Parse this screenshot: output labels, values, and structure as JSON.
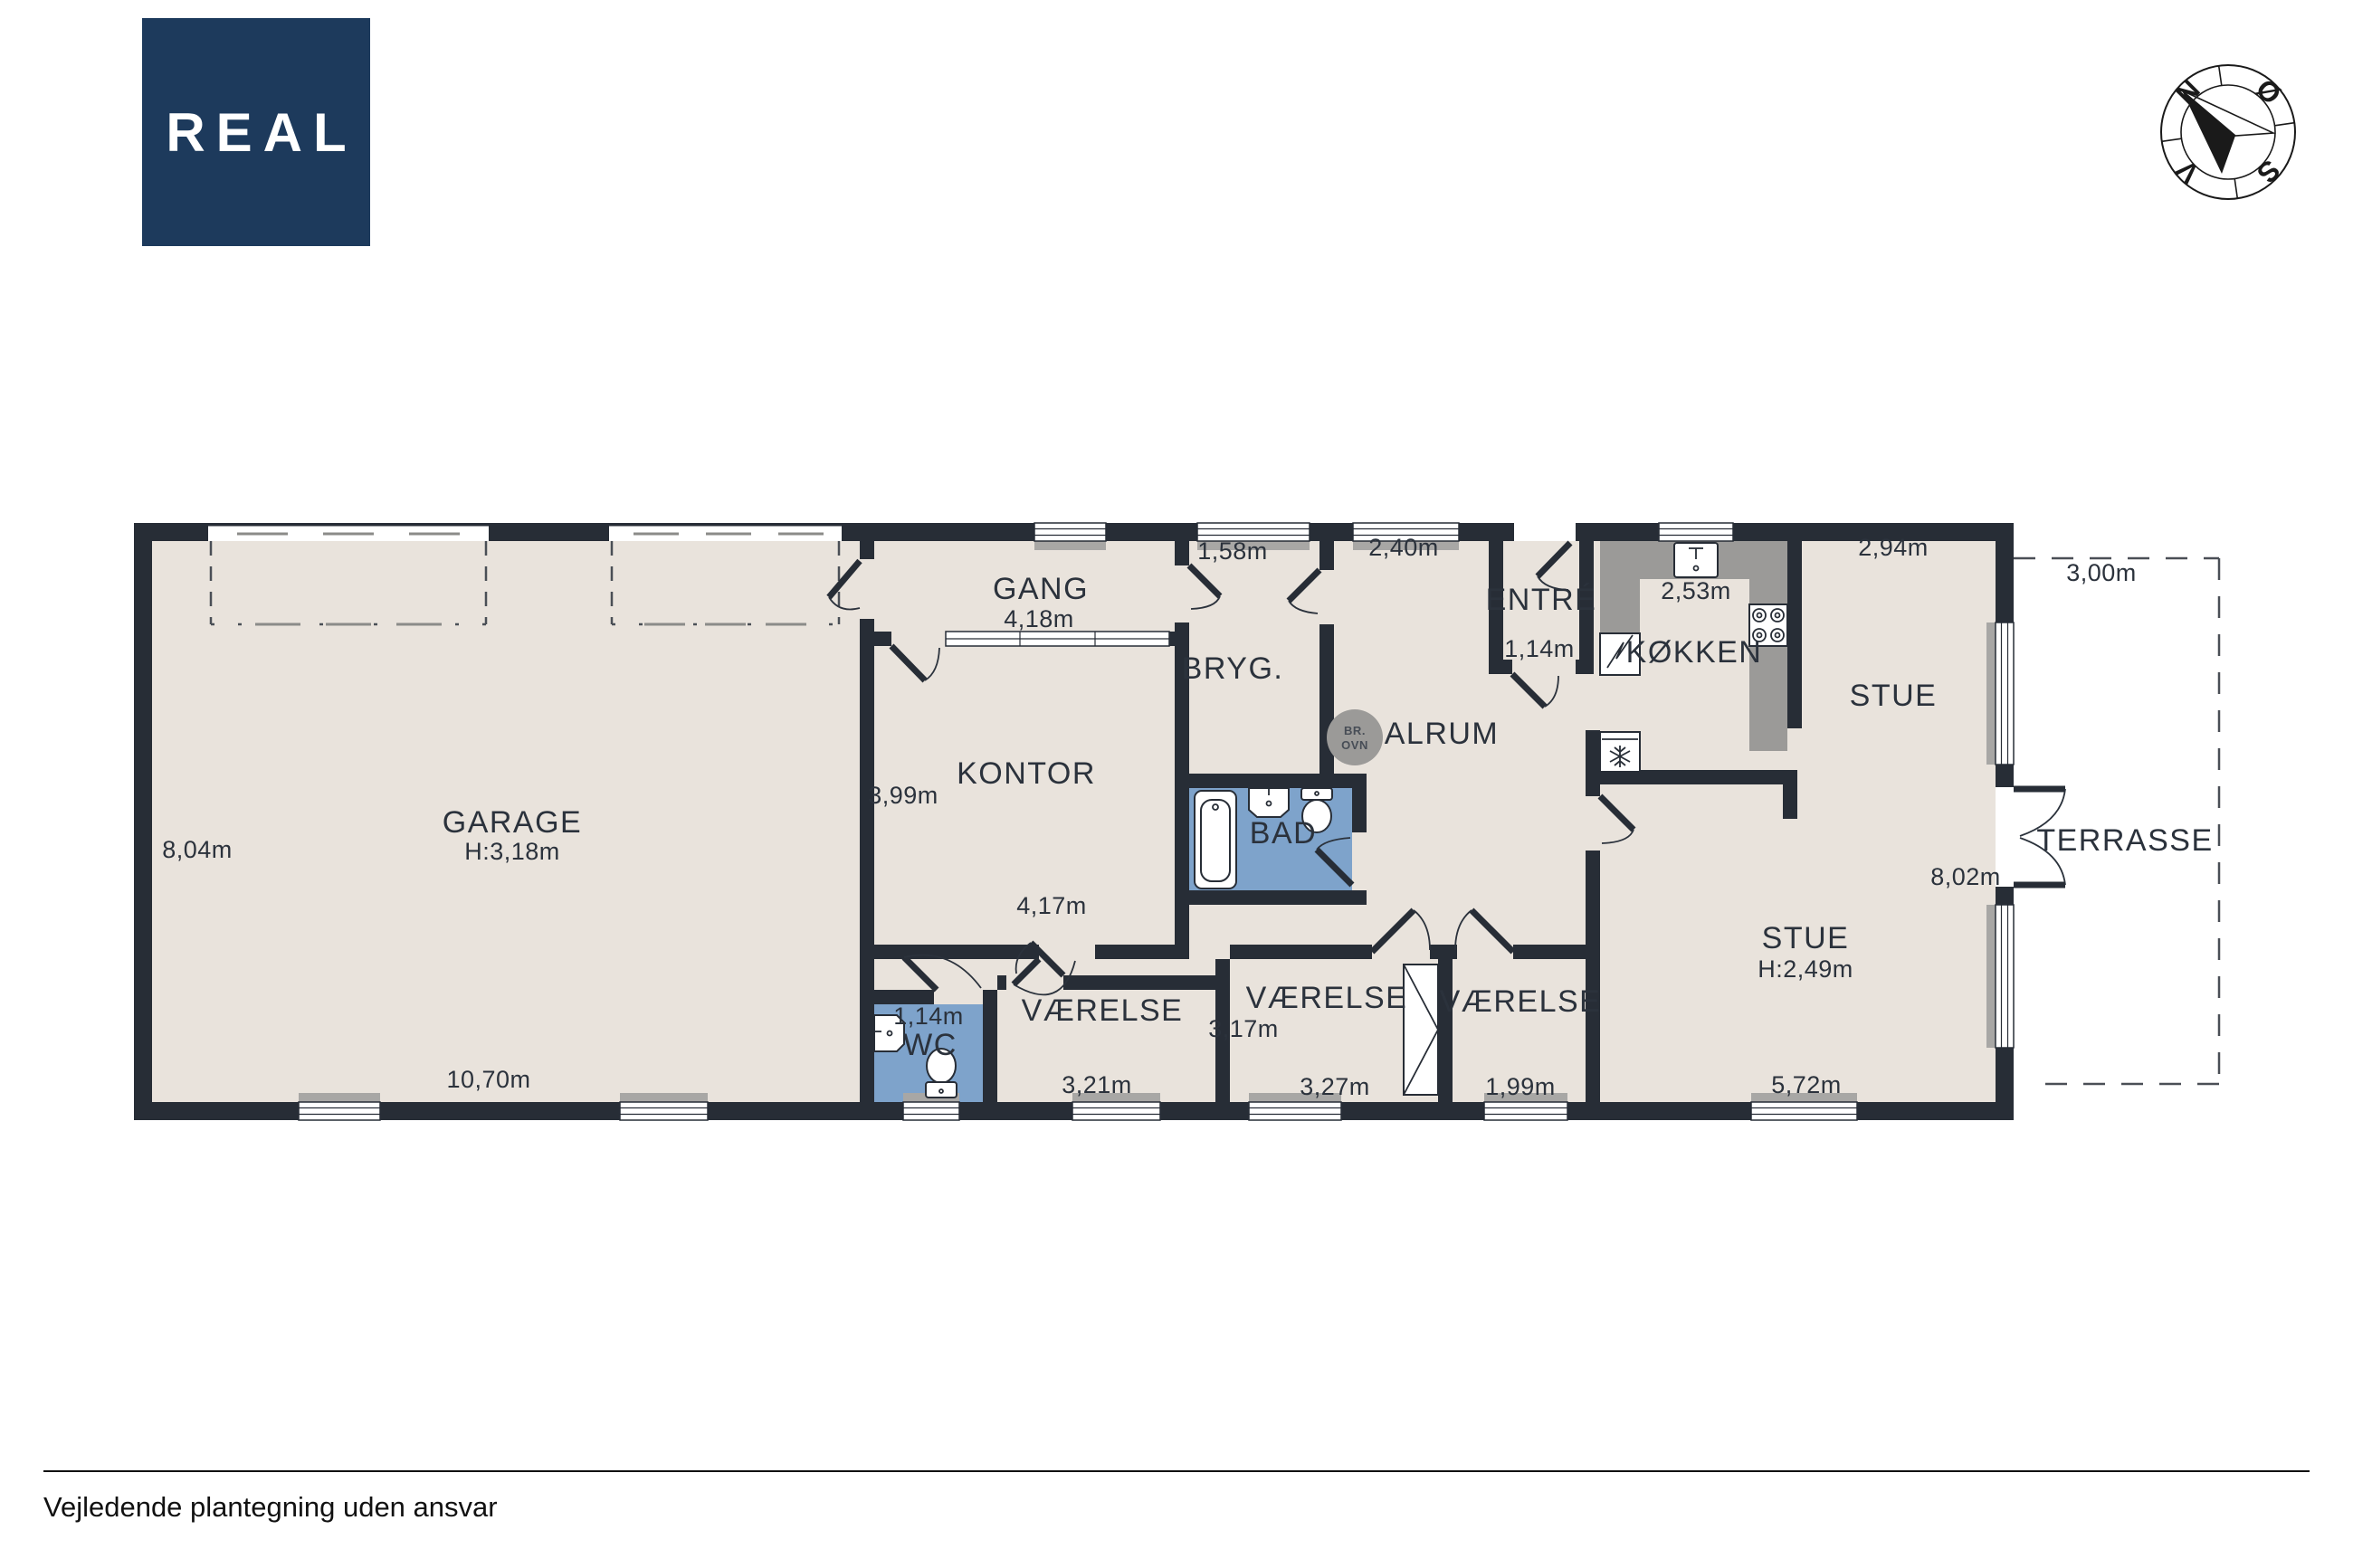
{
  "logo": {
    "text": "REAL"
  },
  "compass": {
    "north": "N",
    "east": "Ø",
    "south": "S",
    "west": "V"
  },
  "plan": {
    "rooms": {
      "garage": {
        "name": "GARAGE",
        "ceiling": "H:3,18m",
        "dim_left": "8,04m",
        "dim_bottom": "10,70m"
      },
      "gang": {
        "name": "GANG",
        "dim": "4,18m"
      },
      "kontor": {
        "name": "KONTOR",
        "dim_left": "3,99m",
        "dim_bottom": "4,17m"
      },
      "bryg": {
        "name": "BRYG.",
        "dim": "1,58m"
      },
      "entre": {
        "name": "ENTRÉ",
        "dim": "1,14m"
      },
      "alrum": {
        "name": "ALRUM",
        "dim": "2,40m"
      },
      "kokken": {
        "name": "KØKKEN",
        "dim": "2,53m"
      },
      "stue_top": {
        "name": "STUE",
        "dim": "2,94m"
      },
      "stue": {
        "name": "STUE",
        "ceiling": "H:2,49m",
        "dim_bottom": "5,72m",
        "dim_right": "8,02m"
      },
      "wc": {
        "name": "WC",
        "dim": "1,14m"
      },
      "bad": {
        "name": "BAD"
      },
      "vaerelse_1": {
        "name": "VÆRELSE",
        "dim_bottom": "3,21m"
      },
      "vaerelse_2": {
        "name": "VÆRELSE",
        "dim_left": "3,17m",
        "dim_bottom": "3,27m"
      },
      "vaerelse_3": {
        "name": "VÆRELSE",
        "dim_bottom": "1,99m"
      },
      "terrasse": {
        "name": "TERRASSE",
        "dim": "3,00m"
      }
    },
    "fixtures": {
      "wood_stove_line1": "BR.",
      "wood_stove_line2": "OVN"
    }
  },
  "footer": {
    "disclaimer": "Vejledende plantegning uden ansvar"
  }
}
